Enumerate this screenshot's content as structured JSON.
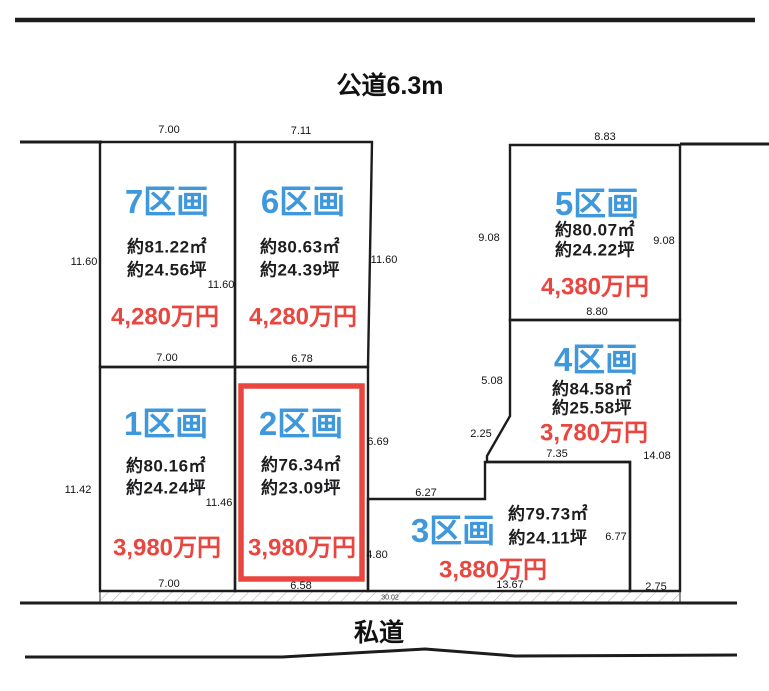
{
  "roads": {
    "top_label": "公道6.3m",
    "bottom_label": "私道"
  },
  "plots": {
    "p7": {
      "name": "7区画",
      "area_m2": "約81.22㎡",
      "area_tsubo": "約24.56坪",
      "price": "4,280万円",
      "highlighted": false
    },
    "p6": {
      "name": "6区画",
      "area_m2": "約80.63㎡",
      "area_tsubo": "約24.39坪",
      "price": "4,280万円",
      "highlighted": false
    },
    "p5": {
      "name": "5区画",
      "area_m2": "約80.07㎡",
      "area_tsubo": "約24.22坪",
      "price": "4,380万円",
      "highlighted": false
    },
    "p4": {
      "name": "4区画",
      "area_m2": "約84.58㎡",
      "area_tsubo": "約25.58坪",
      "price": "3,780万円",
      "highlighted": false
    },
    "p1": {
      "name": "1区画",
      "area_m2": "約80.16㎡",
      "area_tsubo": "約24.24坪",
      "price": "3,980万円",
      "highlighted": false
    },
    "p2": {
      "name": "2区画",
      "area_m2": "約76.34㎡",
      "area_tsubo": "約23.09坪",
      "price": "3,980万円",
      "highlighted": true
    },
    "p3": {
      "name": "3区画",
      "area_m2": "約79.73㎡",
      "area_tsubo": "約24.11坪",
      "price": "3,880万円",
      "highlighted": false
    }
  },
  "dims": {
    "plot7_top": "7.00",
    "plot6_top": "7.11",
    "plot5_top": "8.83",
    "plot7_left": "11.60",
    "plot7_right_inner": "11.60",
    "plot6_right": "11.60",
    "plot5_left": "9.08",
    "plot5_right": "9.08",
    "plot5_bottom": "8.80",
    "plot7_bottom": "7.00",
    "plot6_bottom": "6.78",
    "plot4_left": "5.08",
    "plot4_diagonal": "2.25",
    "plot4_inner_bottom": "7.35",
    "plot4_right": "14.08",
    "plot1_left": "11.42",
    "plot1_right_inner": "11.46",
    "plot2_right_upper": "6.69",
    "plot3_top": "6.27",
    "plot2_right_lower": "4.80",
    "plot3_right_inner": "6.77",
    "plot1_bottom": "7.00",
    "plot2_bottom": "6.58",
    "plot3_bottom": "13.67",
    "plot4_strip_bottom": "2.75",
    "frontage_total": "30.02"
  },
  "colors": {
    "plot_label_blue": "#3f97dc",
    "price_red": "#e8463f",
    "highlight_red": "#e8463f",
    "line_black": "#1c1c1c"
  }
}
